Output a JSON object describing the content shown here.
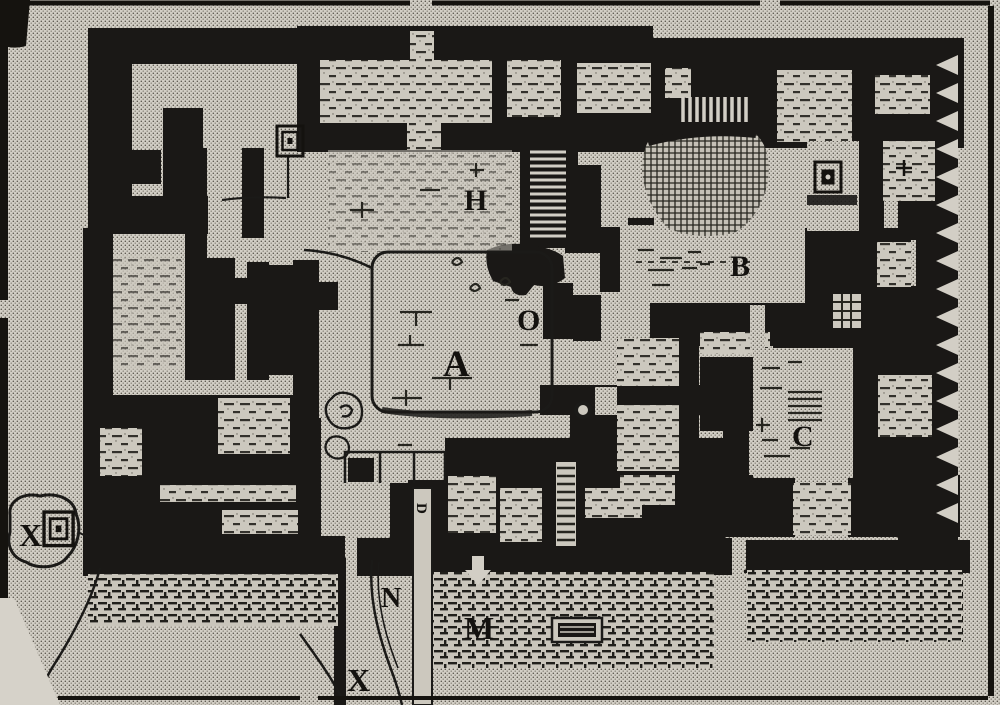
{
  "plan": {
    "labels": [
      {
        "id": "H",
        "text": "H"
      },
      {
        "id": "B",
        "text": "B"
      },
      {
        "id": "O",
        "text": "O"
      },
      {
        "id": "A",
        "text": "A"
      },
      {
        "id": "C",
        "text": "C"
      },
      {
        "id": "X-west",
        "text": "X"
      },
      {
        "id": "D",
        "text": "D"
      },
      {
        "id": "N",
        "text": "N"
      },
      {
        "id": "M",
        "text": "M"
      },
      {
        "id": "X-south",
        "text": "X"
      }
    ],
    "palette": {
      "paper": "#d2cec5",
      "ink": "#1a1816",
      "hatch": "#2b2a26"
    },
    "icons": [
      "spiral-square-marker-west",
      "spiral-square-marker-north",
      "square-basin-marker",
      "grid-hatch-marker",
      "ring-marker",
      "staircase",
      "sawtooth-excavation-edge"
    ]
  }
}
